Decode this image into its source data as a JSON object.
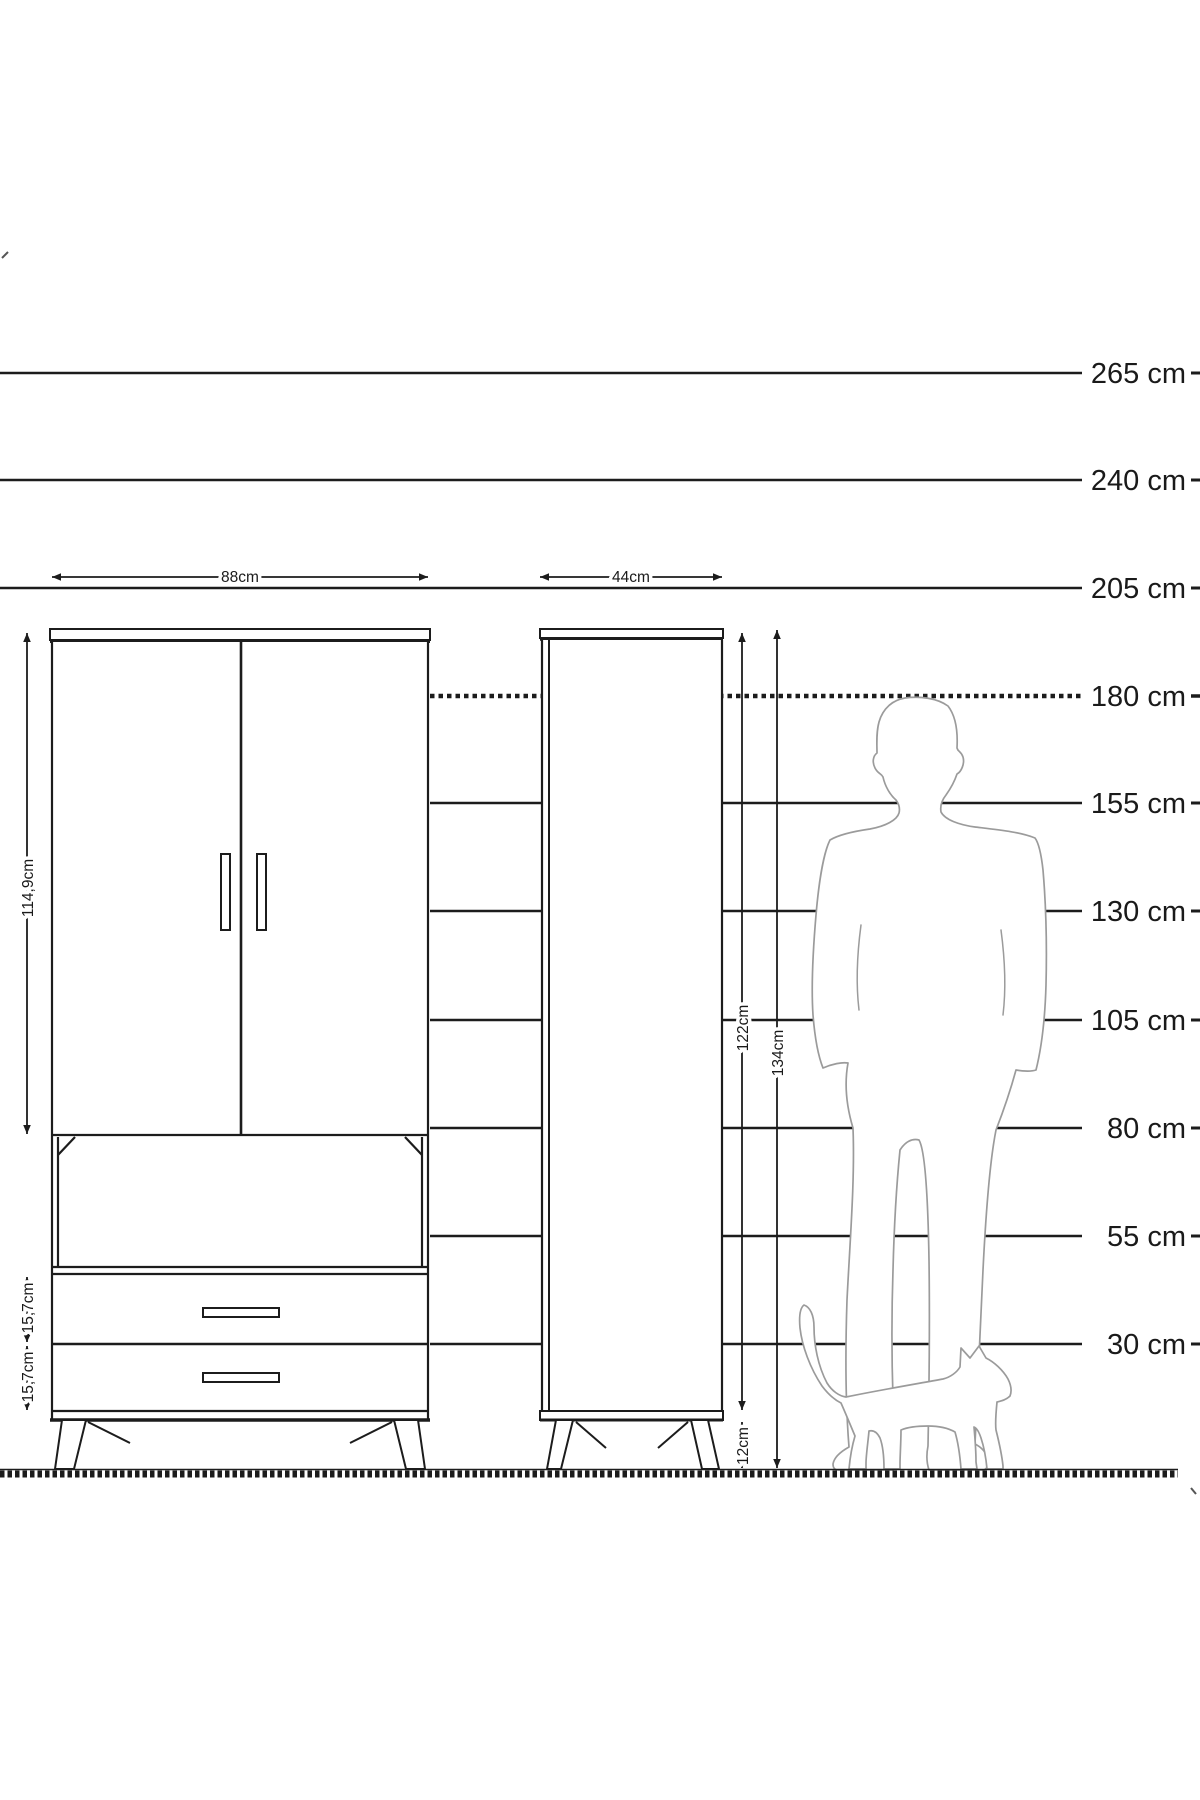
{
  "diagram_title": "furniture-height-dimension-diagram",
  "colors": {
    "line": "#1c1c1c",
    "silhouette": "#9b9b9b",
    "background": "#ffffff",
    "text": "#1a1a1a"
  },
  "scale": {
    "unit": "cm",
    "lines": [
      {
        "label": "265 cm",
        "value": 265,
        "style": "solid"
      },
      {
        "label": "240 cm",
        "value": 240,
        "style": "solid"
      },
      {
        "label": "205 cm",
        "value": 205,
        "style": "solid"
      },
      {
        "label": "180 cm",
        "value": 180,
        "style": "dashed"
      },
      {
        "label": "155 cm",
        "value": 155,
        "style": "solid"
      },
      {
        "label": "130 cm",
        "value": 130,
        "style": "solid"
      },
      {
        "label": "105 cm",
        "value": 105,
        "style": "solid"
      },
      {
        "label": "80 cm",
        "value": 80,
        "style": "solid"
      },
      {
        "label": "55 cm",
        "value": 55,
        "style": "solid"
      },
      {
        "label": "30 cm",
        "value": 30,
        "style": "solid"
      }
    ]
  },
  "wardrobe": {
    "name": "two-door wardrobe with open shelf and two drawers",
    "width_label": "88cm",
    "door_height_label": "114,9cm",
    "drawer1_height_label": "15,7cm",
    "drawer2_height_label": "15,7cm"
  },
  "cabinet": {
    "name": "tall single-door cabinet",
    "width_label": "44cm",
    "door_height_label": "122cm",
    "total_height_label": "134cm",
    "leg_height_label": "12cm"
  },
  "figures": {
    "man_icon": "man-silhouette",
    "cat_icon": "cat-silhouette",
    "ground_icon": "hatched-ground-line"
  }
}
